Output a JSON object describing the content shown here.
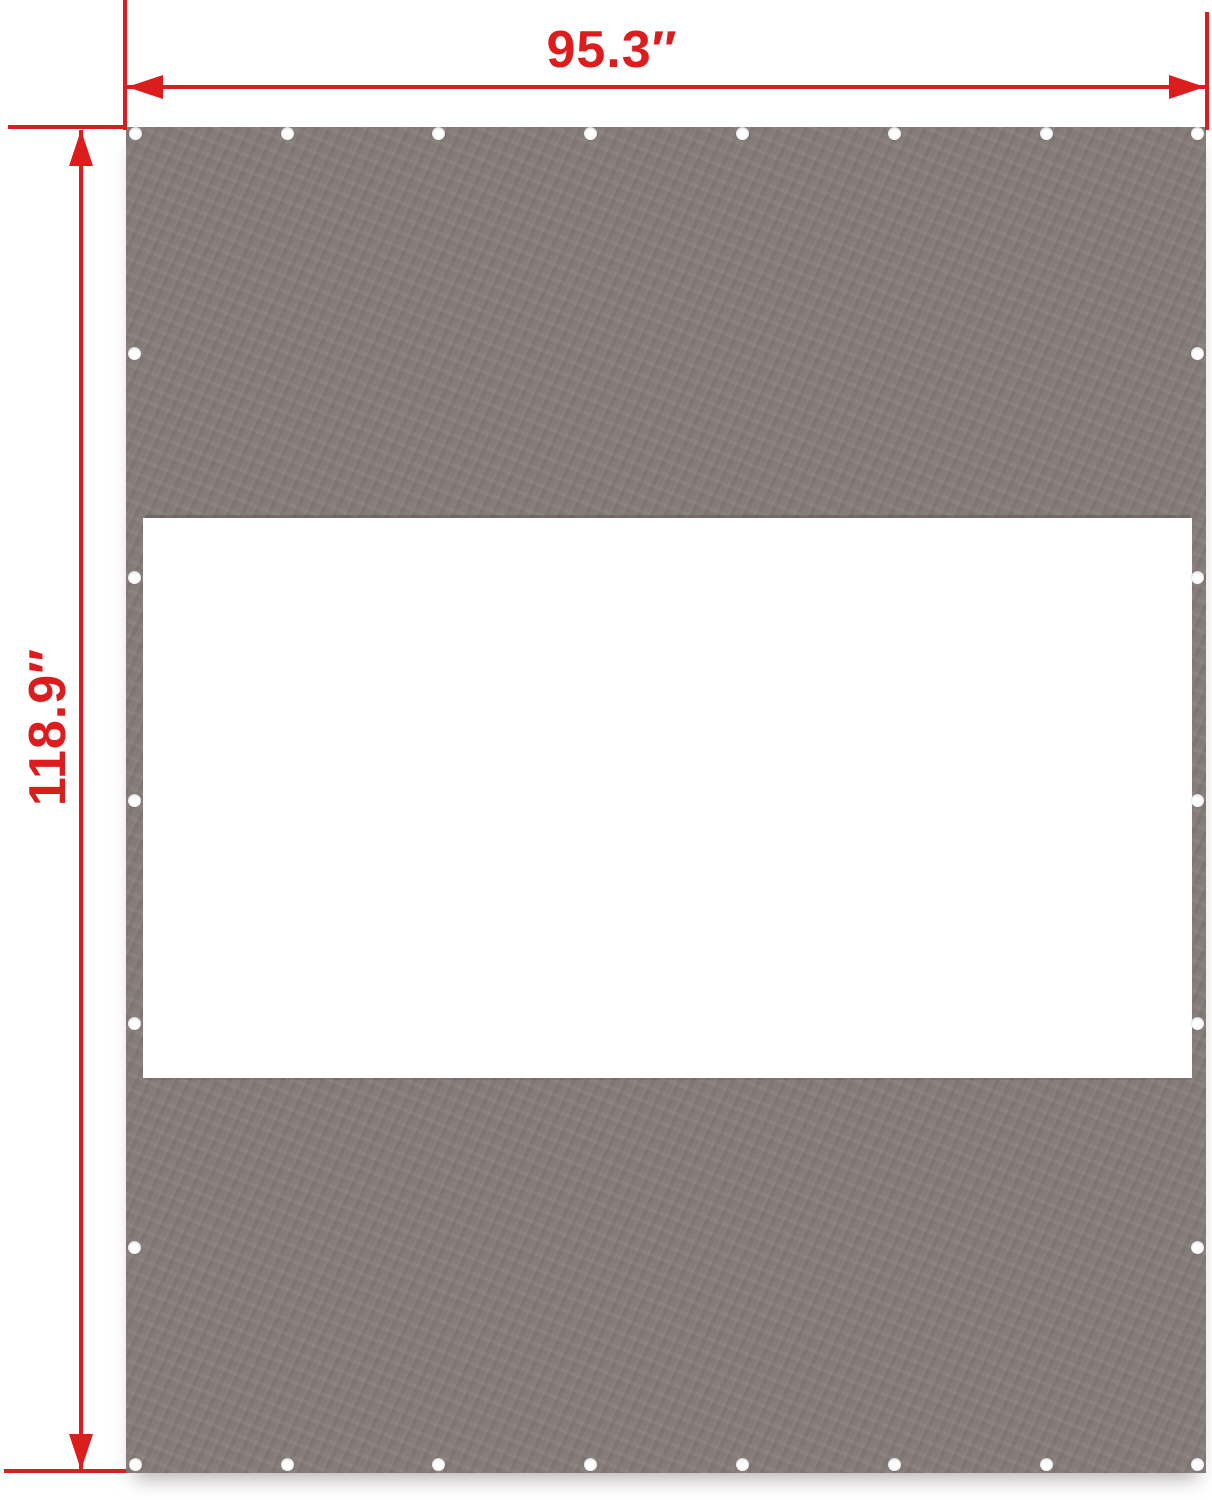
{
  "diagram": {
    "type": "product-dimension-diagram",
    "subject": "tarp sidewall panel with window cutout and grommets",
    "colors": {
      "accent": "#dd1d1d",
      "panel": "#857b78",
      "window": "#ffffff",
      "background": "#ffffff",
      "grommet": "#ffffff"
    },
    "dimensions": {
      "width_label": "95.3″",
      "height_label": "118.9″"
    },
    "grommets": {
      "diameter_px": 13,
      "top_row": {
        "y": 133,
        "x": [
          135,
          287,
          438,
          590,
          742,
          894,
          1046,
          1197
        ]
      },
      "bottom_row": {
        "y": 1464,
        "x": [
          135,
          287,
          438,
          590,
          742,
          894,
          1046,
          1197
        ]
      },
      "left_column": {
        "x": 134,
        "y": [
          353,
          577,
          800,
          1023,
          1247
        ]
      },
      "right_column": {
        "x": 1197,
        "y": [
          353,
          577,
          800,
          1023,
          1247
        ]
      }
    }
  }
}
